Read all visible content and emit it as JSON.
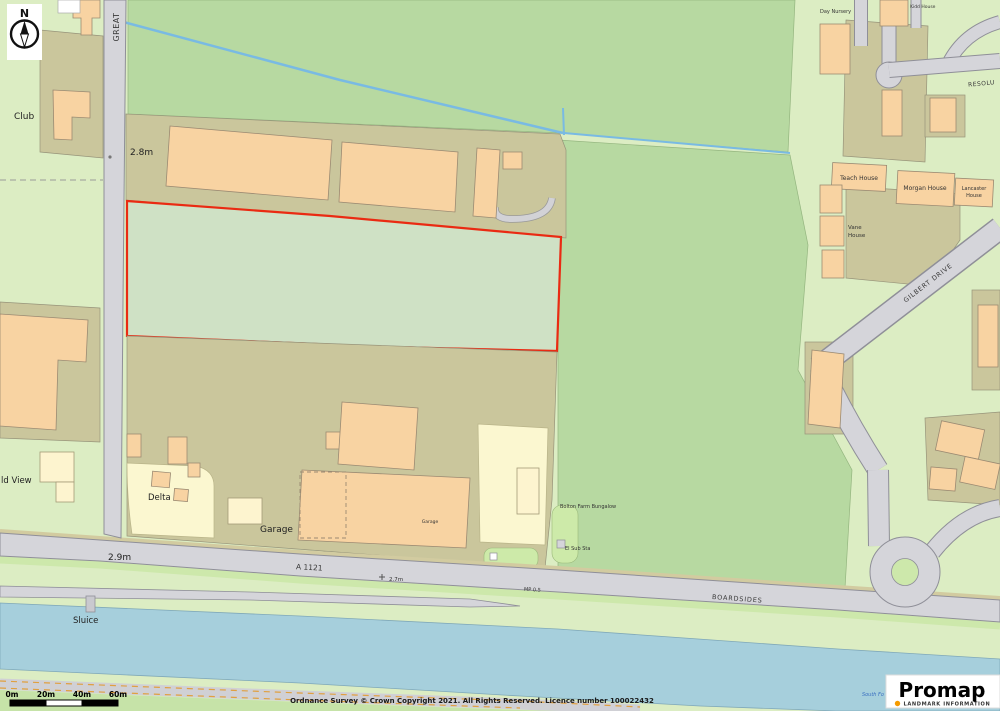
{
  "map": {
    "labels": {
      "club": "Club",
      "great_road": "GREAT",
      "spot_height_28": "2.8m",
      "spot_height_29": "2.9m",
      "spot_height_27": "2.7m",
      "milepost": "MP 0.5",
      "field_view": "ld View",
      "delta": "Delta",
      "garage_area": "Garage",
      "garage_building": "Garage",
      "sluice": "Sluice",
      "a1121": "A 1121",
      "boardsides": "BOARDSIDES",
      "gilbert_drive": "GILBERT DRIVE",
      "resolution": "RESOLU",
      "day_nursery": "Day Nursery",
      "kidd_house": "Kidd House",
      "teach_house": "Teach House",
      "morgan_house": "Morgan House",
      "lancaster_house_line1": "Lancaster",
      "lancaster_house_line2": "House",
      "vane_house_line1": "Vane",
      "vane_house_line2": "House",
      "farm_bungalow": "Bolton Farm Bungalow",
      "el_sub_sta": "El Sub Sta",
      "drain_name": "South Fo"
    },
    "compass": {
      "north": "N"
    },
    "scale_bar": {
      "labels": [
        "0m",
        "20m",
        "40m",
        "60m"
      ]
    },
    "footer": {
      "copyright": "Ordnance Survey © Crown Copyright 2021. All Rights Reserved. Licence number 100022432"
    },
    "logo": {
      "name": "Promap",
      "subtitle": "LANDMARK INFORMATION"
    },
    "colors": {
      "open_land": "#dcedc3",
      "field": "#b7d9a1",
      "plot": "#cac69c",
      "building": "#f8d3a2",
      "building_cream": "#fdf4cf",
      "garden_yellow": "#fbf7d0",
      "road": "#d5d5da",
      "verge": "#cde8ab",
      "water": "#a6cfdc",
      "stream": "#79bae3",
      "boundary_red": "#ea2a12",
      "promap_orange": "#f59b00"
    }
  }
}
